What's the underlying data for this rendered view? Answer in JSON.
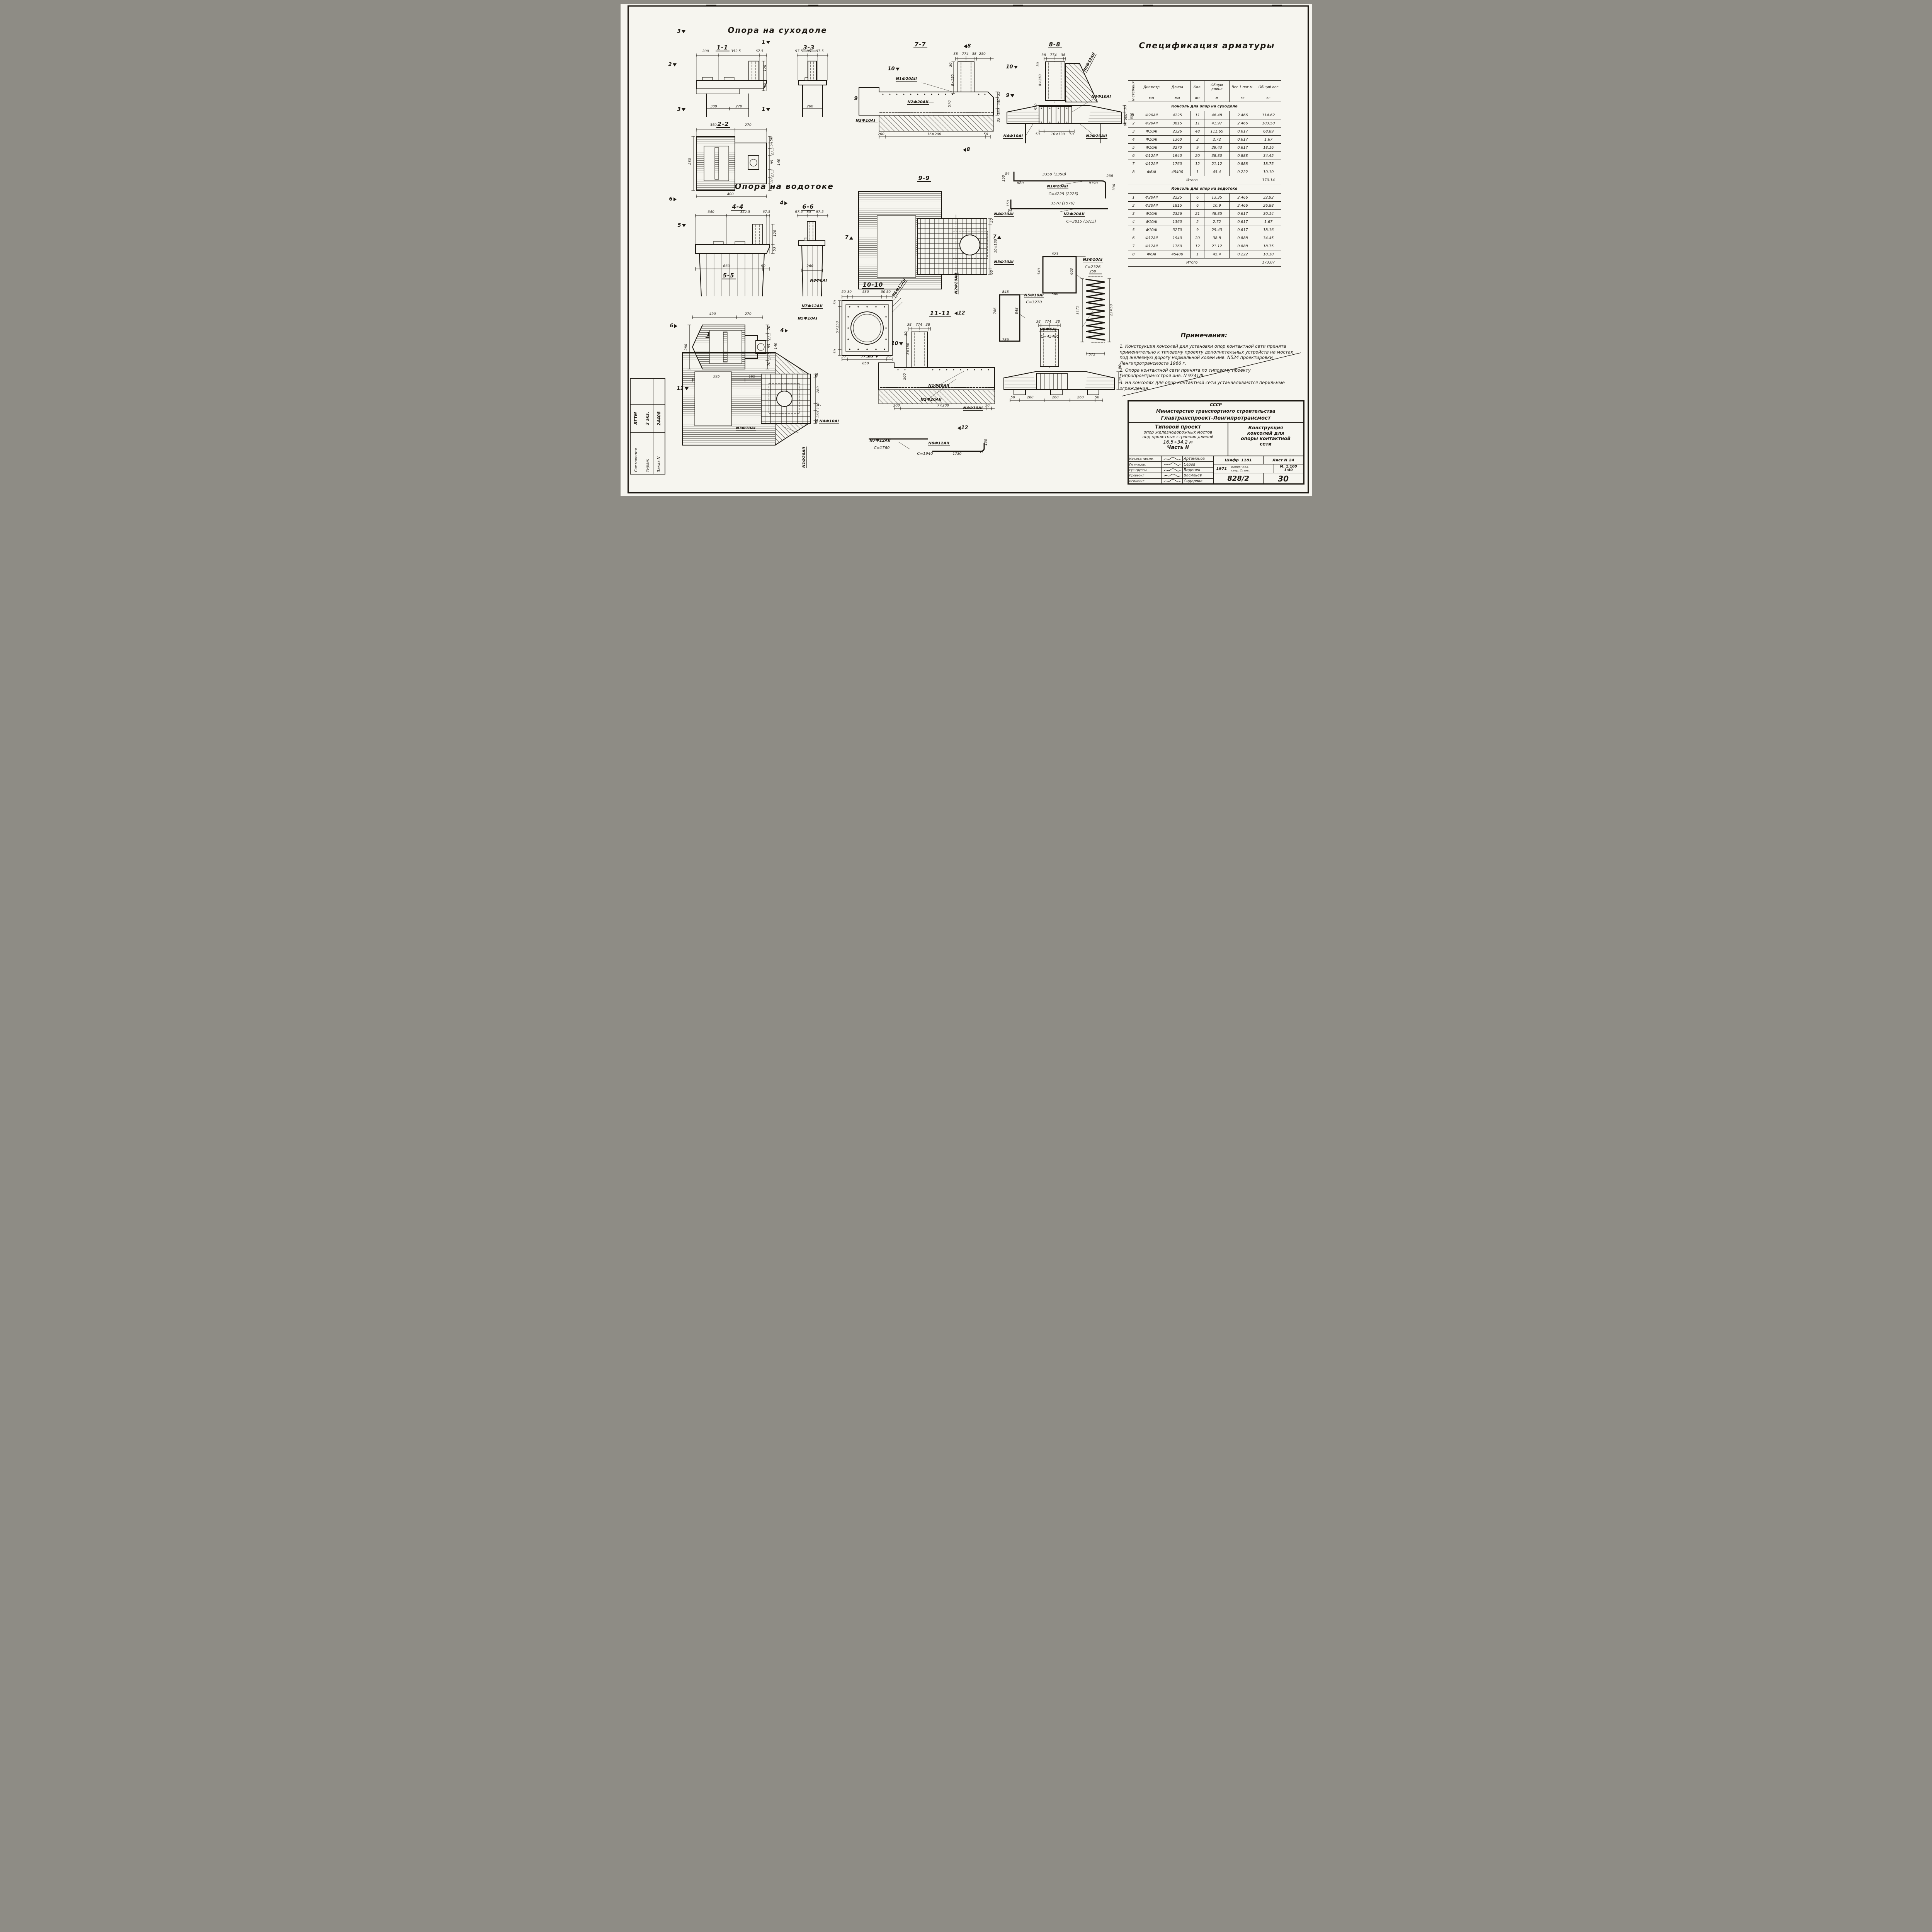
{
  "headings": {
    "dry": "Опора на суходоле",
    "wet": "Опора на водотоке"
  },
  "cut": {
    "c1": "1",
    "c2": "2",
    "c3": "3",
    "c4": "4",
    "c5": "5",
    "c6": "6",
    "c7": "7",
    "c8": "8",
    "c9": "9",
    "c10": "10",
    "c11": "11",
    "c12": "12",
    "c13": "13"
  },
  "sections": {
    "s11": {
      "title": "1-1",
      "dims": [
        "200",
        "352.5",
        "67.5",
        "120",
        "60",
        "300",
        "270"
      ]
    },
    "s22": {
      "title": "2-2",
      "dims": [
        "350",
        "270",
        "280",
        "400",
        "50",
        "20",
        "27.5",
        "85",
        "27.5",
        "20",
        "50",
        "140"
      ]
    },
    "s33": {
      "title": "3-3",
      "dims": [
        "97.5",
        "85",
        "97.5",
        "260"
      ]
    },
    "s44": {
      "title": "4-4",
      "dims": [
        "340",
        "352.5",
        "67.5",
        "120",
        "53",
        "660",
        "90"
      ]
    },
    "s55": {
      "title": "5-5",
      "dims": [
        "490",
        "270",
        "280",
        "595",
        "165",
        "70",
        "27.5",
        "85",
        "140",
        "27.5",
        "70"
      ]
    },
    "s66": {
      "title": "6-6",
      "dims": [
        "97.5",
        "85",
        "97.5",
        "260"
      ]
    },
    "s77": {
      "title": "7-7",
      "dims": [
        "38",
        "774",
        "38",
        "250",
        "30",
        "8×150",
        "570",
        "35",
        "150",
        "360",
        "35",
        "200",
        "16×200",
        "50"
      ]
    },
    "s88": {
      "title": "8-8",
      "dims": [
        "38",
        "774",
        "38",
        "30",
        "8×150",
        "570",
        "50",
        "500",
        "90",
        "600",
        "50",
        "10×130",
        "50"
      ]
    },
    "s99": {
      "title": "9-9",
      "dims": [
        "50",
        "10×130",
        "50"
      ]
    },
    "s1010": {
      "title": "10-10",
      "dims": [
        "50",
        "30",
        "530",
        "30",
        "50",
        "50",
        "5×150",
        "50",
        "5×150",
        "850"
      ]
    },
    "s1111": {
      "title": "11-11",
      "dims": [
        "38",
        "774",
        "38",
        "30",
        "8×150",
        "500",
        "200",
        "7×200",
        "50"
      ]
    },
    "s1212": {
      "title": "12-12",
      "dims": [
        "38",
        "774",
        "38",
        "50",
        "260",
        "260",
        "260",
        "50",
        "530",
        "90"
      ]
    },
    "s1313": {
      "title": "13-13",
      "dims": [
        "50",
        "260",
        "130",
        "260",
        "50"
      ]
    }
  },
  "bars": {
    "n1": {
      "name": "N1Ф20АII",
      "c": "С=4225 (2225)",
      "top": "3350 (1350)",
      "a": "94",
      "b": "150",
      "r1": "R60",
      "r2": "R190",
      "e": "238",
      "f": "330"
    },
    "n2": {
      "name": "N2Ф20АII",
      "c": "С=3815 (1815)",
      "top": "3570 (1570)",
      "a": "150",
      "b": "94"
    },
    "n3": {
      "name": "N3Ф10АI",
      "c": "С=2326",
      "t": "623",
      "l": "540",
      "r": "603",
      "b": "560"
    },
    "n4": {
      "name": "N4Ф10АI"
    },
    "n5": {
      "name": "N5Ф10АI",
      "c": "С=3270",
      "t": "848",
      "l": "786",
      "r": "848",
      "b": "786"
    },
    "n6": {
      "name": "N6Ф12АII",
      "c": "С=1940",
      "a": "1730",
      "b": "150",
      "d": "57"
    },
    "n7": {
      "name": "N7Ф12АII",
      "c": "С=1760"
    },
    "n8": {
      "name": "N8Ф6АI",
      "c": "С=45400",
      "t": "250",
      "l": "1175",
      "r": "23×50",
      "b": "572"
    }
  },
  "spec": {
    "title": "Спецификация арматуры",
    "headers": {
      "num": "N стержня",
      "dia": "Диаметр",
      "len": "Длина",
      "qty": "Кол.",
      "tlen": "Общая длина",
      "uw": "Вес 1 пог.м.",
      "tw": "Общий вес"
    },
    "units": {
      "dia": "мм",
      "len": "мм",
      "qty": "шт",
      "tlen": "м",
      "uw": "кг",
      "tw": "кг"
    },
    "total_label": "Итого",
    "groups": [
      {
        "title": "Консоль для опор на суходоле",
        "total": "370.14",
        "rows": [
          [
            "1",
            "Ф20АII",
            "4225",
            "11",
            "46.48",
            "2.466",
            "114.62"
          ],
          [
            "2",
            "Ф20АII",
            "3815",
            "11",
            "41.97",
            "2.466",
            "103.50"
          ],
          [
            "3",
            "Ф10АI",
            "2326",
            "48",
            "111.65",
            "0.617",
            "68.89"
          ],
          [
            "4",
            "Ф10АI",
            "1360",
            "2",
            "2.72",
            "0.617",
            "1.67"
          ],
          [
            "5",
            "Ф10АI",
            "3270",
            "9",
            "29.43",
            "0.617",
            "18.16"
          ],
          [
            "6",
            "Ф12АII",
            "1940",
            "20",
            "38.80",
            "0.888",
            "34.45"
          ],
          [
            "7",
            "Ф12АII",
            "1760",
            "12",
            "21.12",
            "0.888",
            "18.75"
          ],
          [
            "8",
            "Ф6АI",
            "45400",
            "1",
            "45.4",
            "0.222",
            "10.10"
          ]
        ]
      },
      {
        "title": "Консоль для опор на водотоке",
        "total": "173.07",
        "rows": [
          [
            "1",
            "Ф20АII",
            "2225",
            "6",
            "13.35",
            "2.466",
            "32.92"
          ],
          [
            "2",
            "Ф20АII",
            "1815",
            "6",
            "10.9",
            "2.466",
            "26.88"
          ],
          [
            "3",
            "Ф10АI",
            "2326",
            "21",
            "48.85",
            "0.617",
            "30.14"
          ],
          [
            "4",
            "Ф10АI",
            "1360",
            "2",
            "2.72",
            "0.617",
            "1.67"
          ],
          [
            "5",
            "Ф10АI",
            "3270",
            "9",
            "29.43",
            "0.617",
            "18.16"
          ],
          [
            "6",
            "Ф12АII",
            "1940",
            "20",
            "38.8",
            "0.888",
            "34.45"
          ],
          [
            "7",
            "Ф12АII",
            "1760",
            "12",
            "21.12",
            "0.888",
            "18.75"
          ],
          [
            "8",
            "Ф6АI",
            "45400",
            "1",
            "45.4",
            "0.222",
            "10.10"
          ]
        ]
      }
    ]
  },
  "notes": {
    "title": "Примечания:",
    "items": [
      {
        "t": "1. Конструкция консолей для установки опор контактной сети принята применительно к типовому проекту дополнительных устройств на мостах под железную дорогу нормальной колеи инв. N524 проектировки Ленгипротрансмоста 1966 г."
      },
      {
        "t": "2. Опора контактной сети принята по типовому проекту Гипропромтрансстроя инв. N 9741/II."
      },
      {
        "t": "3. На консолях для опор контактной сети устанавливаются перильные ограждения."
      }
    ]
  },
  "title_block": {
    "country": "СССР",
    "ministry": "Министерство транспортного строительства",
    "org": "Главтранспроект-Ленгипротрансмост",
    "project": [
      "Типовой проект",
      "опор железнодорожных мостов",
      "под пролетные строения длиной",
      "16.5÷34.2 м",
      "Часть II"
    ],
    "sheet_name": [
      "Конструкция",
      "консолей для",
      "опоры контактной",
      "сети"
    ],
    "roles": [
      {
        "role": "Нач.отд.тип.пр.",
        "name": "Артамонов"
      },
      {
        "role": "Гл.инж.пр.",
        "name": "Серов"
      },
      {
        "role": "Рук.группы",
        "name": "Виденек"
      },
      {
        "role": "Проверил",
        "name": "Васильев"
      },
      {
        "role": "Исполнил",
        "name": "Сидорова"
      }
    ],
    "cipher_label": "Шифр",
    "cipher": "1181",
    "sheets_label": "Лист N",
    "sheets": "24",
    "year": "1971",
    "copy_note": "Копир: Кол.",
    "check_note": "свер. Станк.",
    "scale_label": "М.",
    "scale1": "1:100",
    "scale2": "1:40",
    "doc_no": "828/2",
    "sheet_no": "30"
  },
  "side_stamp": {
    "rows": [
      {
        "a": "Светокопия",
        "b": "ЛГТМ"
      },
      {
        "a": "Тираж",
        "b": "3 экз."
      },
      {
        "a": "Заказ N",
        "b": "24408"
      }
    ]
  }
}
